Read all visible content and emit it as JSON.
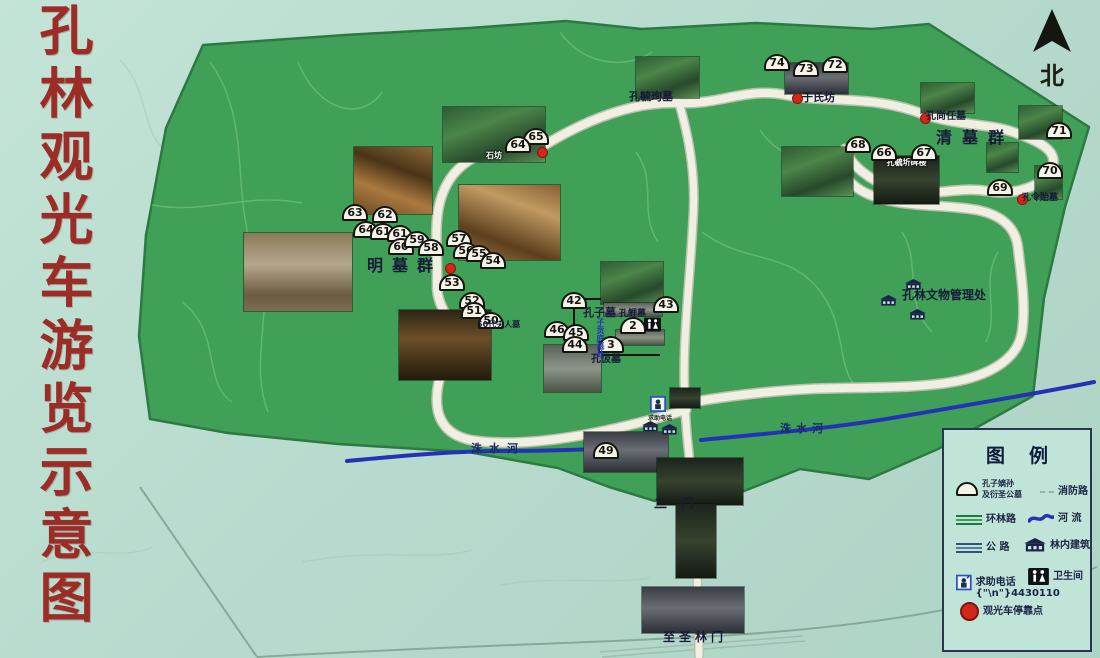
{
  "title": "孔林观光车游览示意图",
  "compass": {
    "label": "北"
  },
  "colors": {
    "background": "#b7dbce",
    "forest": "#40a058",
    "forest_edge": "#2c7a42",
    "road": "#f1eee2",
    "river": "#2433b5",
    "title_red": "#9b2d26",
    "stop_red": "#d2271b",
    "ink": "#171a38"
  },
  "map": {
    "labels": [
      {
        "id": "kongyuxun-tomb",
        "text": "孔毓珣墓",
        "x": 629,
        "y": 88,
        "size": 11
      },
      {
        "id": "yushifang",
        "text": "于氏坊",
        "x": 802,
        "y": 89,
        "size": 11
      },
      {
        "id": "kongshangren-tomb",
        "text": "孔尚任墓",
        "x": 926,
        "y": 107,
        "size": 10
      },
      {
        "id": "qing-tomb-group",
        "text": "清墓群",
        "x": 936,
        "y": 124,
        "size": 16,
        "spacing": 10
      },
      {
        "id": "konglingyi-tomb",
        "text": "孔令贻墓",
        "x": 1022,
        "y": 190,
        "size": 9
      },
      {
        "id": "ming-tomb-group",
        "text": "明墓群",
        "x": 367,
        "y": 252,
        "size": 16,
        "spacing": 9
      },
      {
        "id": "kongzi-tomb",
        "text": "孔子墓",
        "x": 583,
        "y": 304,
        "size": 11
      },
      {
        "id": "kongli-tomb",
        "text": "孔鲤墓",
        "x": 619,
        "y": 306,
        "size": 9
      },
      {
        "id": "kongji-tomb",
        "text": "孔伋墓",
        "x": 591,
        "y": 350,
        "size": 10
      },
      {
        "id": "zigong-mourning-hut",
        "text": "子贡庐墓处",
        "x": 595,
        "y": 318,
        "size": 8,
        "color": "#2335b2",
        "vertical": true
      },
      {
        "id": "madam-50th-tomb",
        "text": "50代夫人墓",
        "x": 477,
        "y": 319,
        "size": 8
      },
      {
        "id": "relics-admin-office",
        "text": "孔林文物管理处",
        "x": 902,
        "y": 286,
        "size": 12
      },
      {
        "id": "zhushui-river-west",
        "text": "洙水河",
        "x": 471,
        "y": 440,
        "size": 11,
        "spacing": 7,
        "color": "#182a63"
      },
      {
        "id": "zhushui-river-east",
        "text": "洙水河",
        "x": 780,
        "y": 420,
        "size": 11,
        "spacing": 5,
        "color": "#182a63"
      },
      {
        "id": "second-gate",
        "text": "二门",
        "x": 654,
        "y": 493,
        "size": 13,
        "spacing": 14
      },
      {
        "id": "zhisheng-forest-gate",
        "text": "至圣林门",
        "x": 663,
        "y": 628,
        "size": 12,
        "spacing": 4
      },
      {
        "id": "help-phone-note",
        "text": "求助电话",
        "x": 648,
        "y": 413,
        "size": 6,
        "color": "#16251f"
      }
    ],
    "markers": [
      {
        "n": "74",
        "x": 764,
        "y": 54
      },
      {
        "n": "73",
        "x": 793,
        "y": 60
      },
      {
        "n": "72",
        "x": 822,
        "y": 56
      },
      {
        "n": "65",
        "x": 523,
        "y": 128
      },
      {
        "n": "64",
        "x": 505,
        "y": 136
      },
      {
        "n": "68",
        "x": 845,
        "y": 136
      },
      {
        "n": "66",
        "x": 871,
        "y": 144
      },
      {
        "n": "67",
        "x": 911,
        "y": 144
      },
      {
        "n": "71",
        "x": 1046,
        "y": 122
      },
      {
        "n": "70",
        "x": 1037,
        "y": 162
      },
      {
        "n": "69",
        "x": 987,
        "y": 179
      },
      {
        "n": "63",
        "x": 342,
        "y": 204
      },
      {
        "n": "62",
        "x": 372,
        "y": 206
      },
      {
        "n": "64",
        "x": 353,
        "y": 221
      },
      {
        "n": "61",
        "x": 370,
        "y": 223
      },
      {
        "n": "61",
        "x": 387,
        "y": 225
      },
      {
        "n": "60",
        "x": 388,
        "y": 238
      },
      {
        "n": "59",
        "x": 404,
        "y": 231
      },
      {
        "n": "58",
        "x": 418,
        "y": 239
      },
      {
        "n": "57",
        "x": 446,
        "y": 230
      },
      {
        "n": "56",
        "x": 453,
        "y": 242
      },
      {
        "n": "55",
        "x": 466,
        "y": 245
      },
      {
        "n": "54",
        "x": 480,
        "y": 252
      },
      {
        "n": "53",
        "x": 439,
        "y": 274
      },
      {
        "n": "52",
        "x": 459,
        "y": 292
      },
      {
        "n": "51",
        "x": 461,
        "y": 302
      },
      {
        "n": "50",
        "x": 478,
        "y": 312
      },
      {
        "n": "42",
        "x": 561,
        "y": 292
      },
      {
        "n": "43",
        "x": 653,
        "y": 296
      },
      {
        "n": "46",
        "x": 544,
        "y": 321
      },
      {
        "n": "45",
        "x": 563,
        "y": 324
      },
      {
        "n": "44",
        "x": 562,
        "y": 336
      },
      {
        "n": "2",
        "x": 620,
        "y": 317
      },
      {
        "n": "3",
        "x": 598,
        "y": 336
      },
      {
        "n": "49",
        "x": 593,
        "y": 442
      }
    ],
    "stops": [
      {
        "id": "stop-shifang",
        "x": 537,
        "y": 147
      },
      {
        "id": "stop-yushifang",
        "x": 792,
        "y": 93
      },
      {
        "id": "stop-kongshangren",
        "x": 920,
        "y": 113
      },
      {
        "id": "stop-konglingyi",
        "x": 1017,
        "y": 194
      },
      {
        "id": "stop-ming-tombs",
        "x": 445,
        "y": 263
      }
    ],
    "photos": [
      {
        "id": "shifang",
        "x": 443,
        "y": 107,
        "w": 102,
        "h": 55,
        "p": "green",
        "caption": "石坊"
      },
      {
        "id": "stone-arch",
        "x": 354,
        "y": 147,
        "w": 78,
        "h": 67,
        "p": "autumn"
      },
      {
        "id": "autumn-forest",
        "x": 459,
        "y": 185,
        "w": 101,
        "h": 75,
        "p": "autumn2"
      },
      {
        "id": "ming-statues",
        "x": 244,
        "y": 233,
        "w": 108,
        "h": 78,
        "p": "stone"
      },
      {
        "id": "dark-forest",
        "x": 399,
        "y": 310,
        "w": 92,
        "h": 70,
        "p": "darkautumn"
      },
      {
        "id": "small-grove",
        "x": 544,
        "y": 345,
        "w": 57,
        "h": 47,
        "p": "grey"
      },
      {
        "id": "kongzi-trees",
        "x": 601,
        "y": 262,
        "w": 62,
        "h": 42,
        "p": "green"
      },
      {
        "id": "kongzi-altar",
        "x": 604,
        "y": 303,
        "w": 58,
        "h": 13,
        "p": "grey"
      },
      {
        "id": "kongli-altar",
        "x": 616,
        "y": 330,
        "w": 48,
        "h": 15,
        "p": "grey"
      },
      {
        "id": "kongyuxun-photo",
        "x": 636,
        "y": 57,
        "w": 63,
        "h": 41,
        "p": "green"
      },
      {
        "id": "yushifang-gate",
        "x": 785,
        "y": 63,
        "w": 63,
        "h": 31,
        "p": "gate"
      },
      {
        "id": "qing-trees",
        "x": 782,
        "y": 147,
        "w": 71,
        "h": 49,
        "p": "green"
      },
      {
        "id": "stele-pavilion",
        "x": 874,
        "y": 156,
        "w": 65,
        "h": 48,
        "p": "dark",
        "caption": "孔毓圻碑楼",
        "cap_top": true
      },
      {
        "id": "kongshangren-photo",
        "x": 921,
        "y": 83,
        "w": 53,
        "h": 30,
        "p": "green"
      },
      {
        "id": "east-grove-1",
        "x": 1019,
        "y": 106,
        "w": 43,
        "h": 33,
        "p": "green"
      },
      {
        "id": "east-grove-2",
        "x": 987,
        "y": 143,
        "w": 31,
        "h": 29,
        "p": "green"
      },
      {
        "id": "east-grove-3",
        "x": 1035,
        "y": 166,
        "w": 27,
        "h": 33,
        "p": "green"
      },
      {
        "id": "junction-photo",
        "x": 670,
        "y": 388,
        "w": 30,
        "h": 20,
        "p": "dark"
      },
      {
        "id": "gate-strip",
        "x": 584,
        "y": 432,
        "w": 84,
        "h": 40,
        "p": "gate"
      },
      {
        "id": "ermen-photo",
        "x": 657,
        "y": 458,
        "w": 86,
        "h": 47,
        "p": "dark"
      },
      {
        "id": "axis-strip",
        "x": 676,
        "y": 504,
        "w": 40,
        "h": 74,
        "p": "dark"
      },
      {
        "id": "zhishenglin-gate-photo",
        "x": 642,
        "y": 587,
        "w": 102,
        "h": 46,
        "p": "gate"
      }
    ],
    "houses": [
      {
        "x": 905,
        "y": 275
      },
      {
        "x": 880,
        "y": 291
      },
      {
        "x": 909,
        "y": 305
      },
      {
        "x": 642,
        "y": 417
      },
      {
        "x": 661,
        "y": 420
      }
    ],
    "wc_icons": [
      {
        "x": 644,
        "y": 317
      }
    ],
    "phone_icons": [
      {
        "x": 650,
        "y": 396
      }
    ]
  },
  "legend": {
    "title": "图例",
    "items": [
      {
        "icon": "dome",
        "label": "孔子嫡孙\n及衍圣公墓"
      },
      {
        "icon": "fire-road",
        "label": "消防路"
      },
      {
        "icon": "ring-road",
        "label": "环林路"
      },
      {
        "icon": "river",
        "label": "河 流"
      },
      {
        "icon": "highway",
        "label": "公 路"
      },
      {
        "icon": "building",
        "label": "林内建筑"
      },
      {
        "icon": "phone",
        "label": "求助电话",
        "sub": "4430110"
      },
      {
        "icon": "wc",
        "label": "卫生间"
      },
      {
        "icon": "stop",
        "label": "观光车停靠点"
      }
    ]
  }
}
